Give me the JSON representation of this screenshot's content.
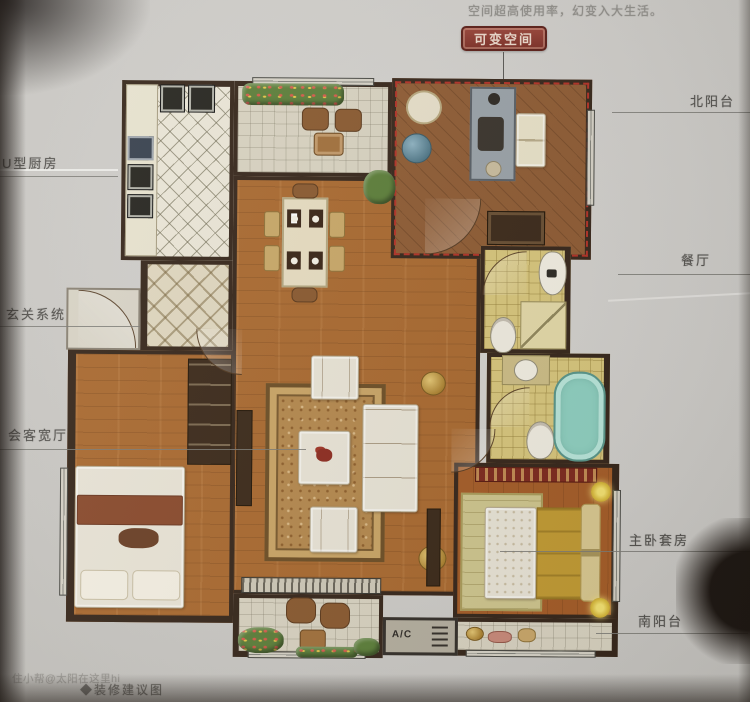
{
  "captions": {
    "top": "空间超高使用率，幻变入大生活。",
    "badge": "可变空间",
    "bottom": "◆装修建议图",
    "watermark": "住小帮@太阳在这里hi"
  },
  "labels": {
    "kitchen": "U型厨房",
    "foyer": "玄关系统",
    "living": "会客宽厅",
    "north_balcony": "北阳台",
    "dining": "餐厅",
    "master": "主卧套房",
    "south_balcony": "南阳台"
  },
  "plan": {
    "ac": "A/C"
  },
  "colors": {
    "paper": "#cfcdc9",
    "wall": "#37271b",
    "wood": "#aa6a30",
    "wood_flex": "#8f5c34",
    "wood_master": "#a55d28",
    "kitchen_tile": "#ebe6d7",
    "bath_tile": "#d8c67c",
    "bathtub": "#8fd0c0",
    "rug": "#b5894e",
    "dash_red": "#b23226",
    "badge_red": "#7c2e25",
    "sofa_white": "#e9e4d6",
    "gold": "#d3a93c",
    "plant_green": "#5d7f3a"
  }
}
